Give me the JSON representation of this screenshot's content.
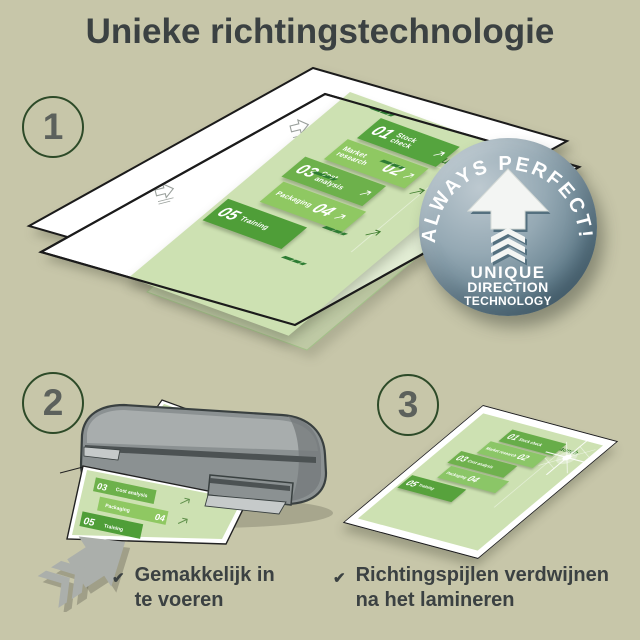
{
  "title": "Unieke richtingstechnologie",
  "glyphs": {
    "check": "✔"
  },
  "steps": [
    {
      "number": "1"
    },
    {
      "number": "2",
      "caption_lines": [
        "Gemakkelijk in",
        "te voeren"
      ]
    },
    {
      "number": "3",
      "caption_lines": [
        "Richtingspijlen verdwijnen",
        "na het lamineren"
      ]
    }
  ],
  "badge": {
    "arc_text": "ALWAYS PERFECT!",
    "lines": [
      "UNIQUE",
      "DIRECTION",
      "TECHNOLOGY"
    ]
  },
  "document": {
    "launch_label": "Launch",
    "bands": [
      {
        "number": "01",
        "label": "Stock check"
      },
      {
        "number": "02",
        "label": "Market research"
      },
      {
        "number": "03",
        "label": "Cost analysis"
      },
      {
        "number": "04",
        "label": "Packaging"
      },
      {
        "number": "05",
        "label": "Training"
      }
    ]
  },
  "colors": {
    "background": "#c7c6a9",
    "text": "#3b4142",
    "circle_green": "#2d4a28",
    "band_dark": "#4f9e38",
    "band_mid": "#6db14b",
    "band_light": "#8fc862",
    "page_green": "#cde1b2",
    "badge_blue": "#66818f",
    "machine_gray": "#8b9192"
  }
}
